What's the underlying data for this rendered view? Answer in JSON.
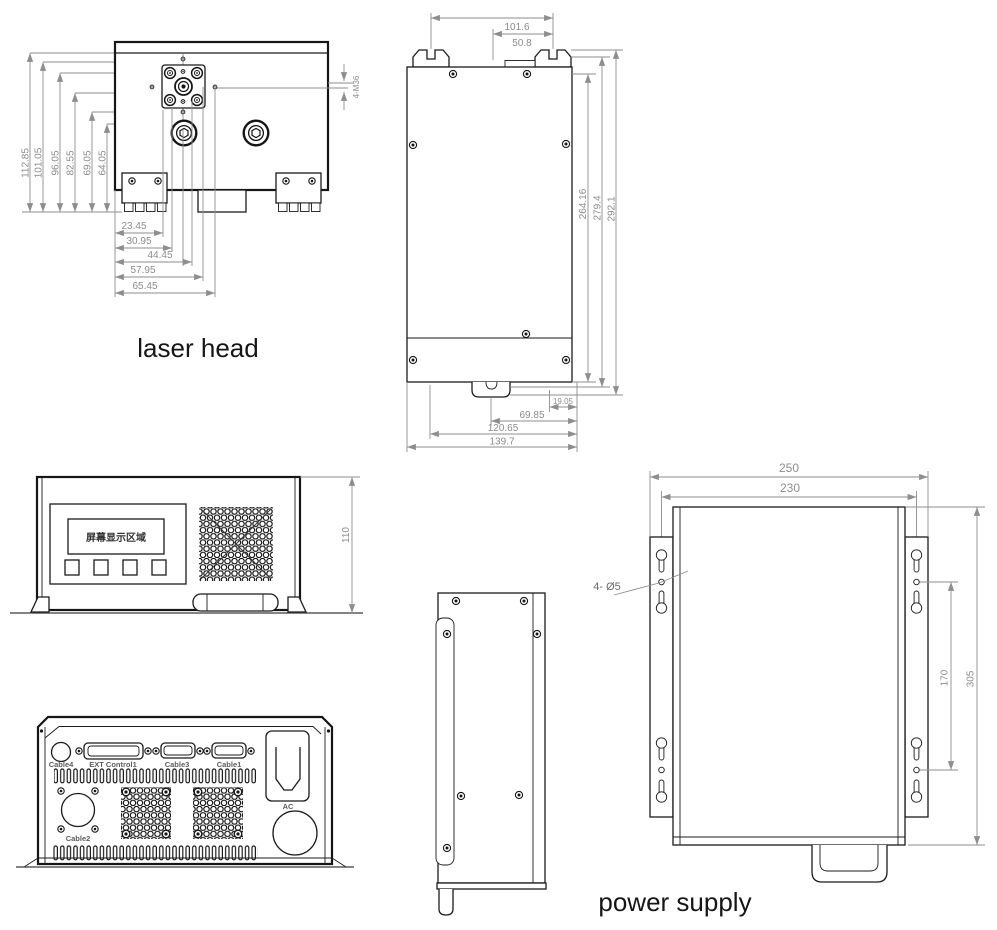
{
  "colors": {
    "line": "#161616",
    "dim_line": "#8e8e8e",
    "dim_text": "#8c8c8c"
  },
  "captions": {
    "laser_head": "laser head",
    "power_supply": "power supply"
  },
  "laser_head_front": {
    "left_dims": [
      "112.85",
      "101.05",
      "96.05",
      "82.55",
      "69.05",
      "64.05"
    ],
    "bottom_dims": [
      "23.45",
      "30.95",
      "44.45",
      "57.95",
      "65.45"
    ],
    "thread_note": "4-M36"
  },
  "laser_head_side": {
    "top_dims": [
      "101.6",
      "50.8"
    ],
    "right_dims": [
      "264.16",
      "279.4",
      "292.1"
    ],
    "bottom_dims": [
      "19.05",
      "69.85",
      "120.65",
      "139.7"
    ]
  },
  "power_supply_front": {
    "display_text": "屏幕显示区域",
    "height_dim": "110"
  },
  "power_supply_rear": {
    "labels": {
      "cable4": "Cable4",
      "ext_control1": "EXT Control1",
      "cable3": "Cable3",
      "cable1": "Cable1",
      "cable2": "Cable2",
      "ac": "AC"
    }
  },
  "power_supply_top": {
    "width_dims": [
      "250",
      "230"
    ],
    "height_dims": [
      "170",
      "305"
    ],
    "hole_note": "4- Ø5"
  }
}
